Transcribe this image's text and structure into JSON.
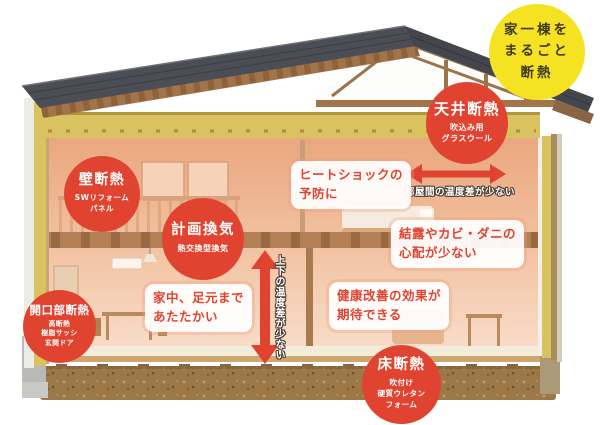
{
  "bubble": {
    "text": "家一棟を\nまるごと\n断熱"
  },
  "badges": {
    "ceiling": {
      "title": "天井断熱",
      "subtitle": "吹込み用\nグラスウール"
    },
    "wall": {
      "title": "壁断熱",
      "subtitle": "SWリフォーム\nパネル"
    },
    "ventilation": {
      "title": "計画換気",
      "subtitle": "熱交換型換気"
    },
    "opening": {
      "title": "開口部断熱",
      "subtitle": "高断熱\n樹脂サッシ\n玄関ドア"
    },
    "floor": {
      "title": "床断熱",
      "subtitle": "吹付け\n硬質ウレタン\nフォーム"
    }
  },
  "callouts": {
    "heat_shock": "ヒートショックの\n予防に",
    "condensation": "結露やカビ・ダニの\n心配が少ない",
    "warm_feet": "家中、足元まで\nあたたかい",
    "health": "健康改善の効果が\n期待できる"
  },
  "arrow_labels": {
    "between_rooms": "部屋間の温度差が少ない",
    "vertical": "上下の温度差が少ない"
  },
  "colors": {
    "accent_red": "#e04430",
    "bubble_yellow": "#f5e222",
    "insulation_yellow": "#d9c361",
    "roof_gray": "#4b4f55",
    "interior_salmon": "#f0b28d",
    "ground_brown": "#9c7848"
  }
}
